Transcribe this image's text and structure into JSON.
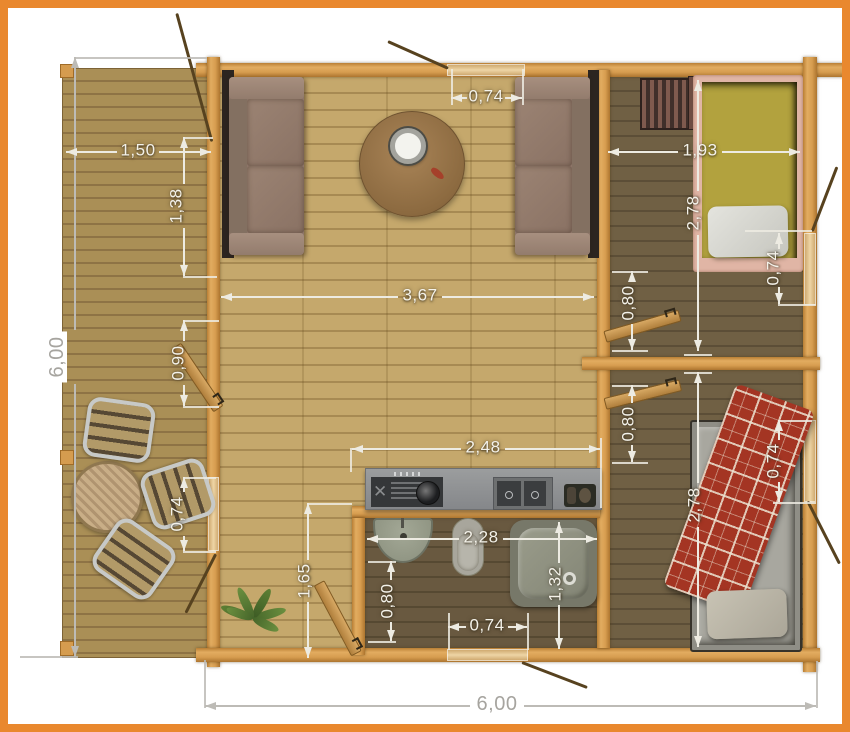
{
  "document": {
    "type": "cabin floor plan",
    "units": "meters (comma decimal)"
  },
  "colors": {
    "frame": "#e9882e",
    "wall_log": "#d79d50",
    "deck_floor": "#aa8f56",
    "living_floor": "#c5a86c",
    "dark_floor": "#706044",
    "dimension": "#edebe2",
    "bed1_mattress": "#b2a23e",
    "bed1_frame": "#e0b5a5",
    "bed2_blanket": "#a43523",
    "fixture_grey": "#949a88",
    "counter_grey": "#8d8f90"
  },
  "dimensions": {
    "overall_height": "6,00",
    "overall_width": "6,00",
    "terrace_width": "1,50",
    "terrace_door": "1,38",
    "terrace_door_small": "0,90",
    "terrace_window": "0,74",
    "top_window": "0,74",
    "living_width": "3,67",
    "bedroom1_width": "1,93",
    "bedroom1_depth": "2,78",
    "bedroom1_window": "0,74",
    "hall_door": "0,80",
    "bedroom2_door": "0,80",
    "bedroom2_depth": "2,78",
    "bedroom2_window": "0,74",
    "kitchen_width": "2,48",
    "bathroom_width": "2,28",
    "bathroom_door": "0,80",
    "bathroom_depth": "1,32",
    "bathroom_offset": "1,65",
    "bathroom_window": "0,74"
  }
}
